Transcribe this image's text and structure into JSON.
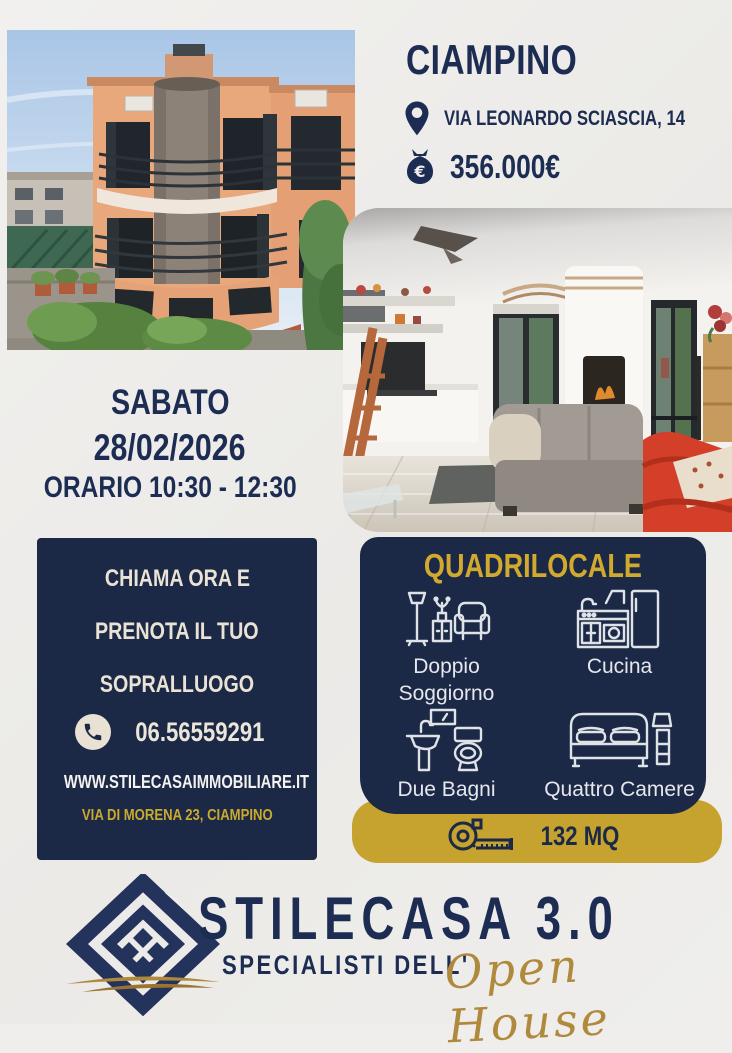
{
  "header": {
    "city": "CIAMPINO",
    "address": "VIA LEONARDO SCIASCIA, 14",
    "price": "356.000€"
  },
  "event": {
    "day": "SABATO",
    "date": "28/02/2026",
    "time": "ORARIO 10:30 - 12:30"
  },
  "contact_box": {
    "line1": "CHIAMA ORA E",
    "line2": "PRENOTA IL TUO",
    "line3": "SOPRALLUOGO",
    "phone": "06.56559291",
    "website": "WWW.STILECASAIMMOBILIARE.IT",
    "office_address": "VIA DI MORENA 23, CIAMPINO"
  },
  "features_box": {
    "title": "QUADRILOCALE",
    "items": [
      {
        "icon": "living-room-icon",
        "label": "Doppio Soggiorno"
      },
      {
        "icon": "kitchen-icon",
        "label": "Cucina"
      },
      {
        "icon": "bathroom-icon",
        "label": "Due Bagni"
      },
      {
        "icon": "bedroom-icon",
        "label": "Quattro Camere"
      }
    ],
    "area": "132 MQ"
  },
  "footer": {
    "brand": "STILECASA 3.0",
    "tagline": "SPECIALISTI DELL'",
    "script_text": "Open House"
  },
  "colors": {
    "navy": "#1b2946",
    "gold": "#c6a32f",
    "gold_text": "#d2a92f",
    "cream": "#eae2d5",
    "background": "#efeeec"
  }
}
